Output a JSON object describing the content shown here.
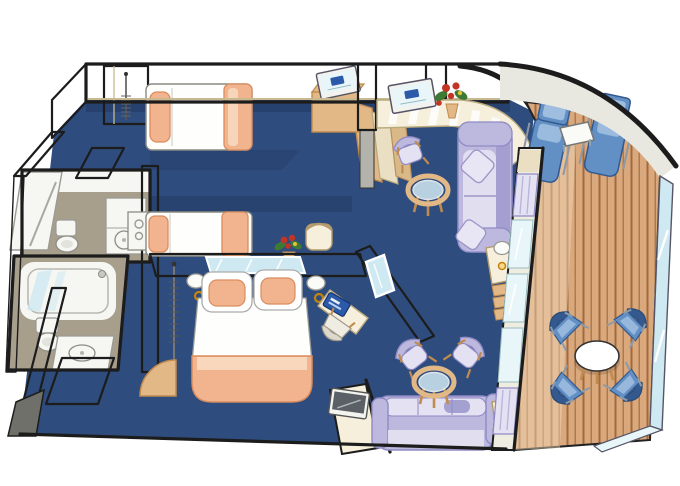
{
  "meta": {
    "kind": "cruise-ship-suite-floor-plan",
    "projection": "oblique-cutaway-illustration",
    "has_text": false
  },
  "palette": {
    "background": "#ffffff",
    "outline": "#1c1c1c",
    "carpet_navy": "#2e4c7d",
    "carpet_navy_dark": "#223962",
    "wall_beige": "#eadfc2",
    "wall_cream": "#f5efdc",
    "wall_gray_light": "#d3d3cc",
    "wall_gray_mid": "#b3b3ac",
    "wall_gray_dark": "#83837c",
    "hull_band": "#e8e8e0",
    "bath_floor_taupe": "#a89e8c",
    "fixture_white": "#f6f6f2",
    "bed_white": "#fefefc",
    "peach": "#f1b48e",
    "peach_deep": "#d98d5e",
    "peach_pale": "#f9ddc4",
    "wood_tan": "#e2b886",
    "wood_deep": "#c08b4e",
    "deck_plank": "#d9a87c",
    "deck_groove": "#a16a3e",
    "deck_plank_light": "#f2dcbc",
    "sofa_lavender": "#bcb8de",
    "sofa_lavender_deep": "#8f8ac4",
    "sofa_lavender_pale": "#e4e2f2",
    "chair_blue": "#6290c4",
    "chair_blue_deep": "#33598e",
    "chair_blue_pale": "#a9c6e4",
    "glass_blue": "#cfe9f2",
    "glass_pale": "#e9f6f9",
    "screen_blue": "#2a5aa8",
    "brass_gold": "#c2840e",
    "flower_red": "#c43424",
    "leaf_green": "#3e7a34"
  },
  "scene": {
    "rooms": [
      {
        "id": "bedroom-forward",
        "floor": "navy-carpet",
        "items": [
          "wardrobe-with-hanger-rail",
          "twin-bed",
          "flat-tv-on-cabinet",
          "open-door"
        ]
      },
      {
        "id": "bedroom-master",
        "floor": "navy-carpet",
        "items": [
          "twin-bed",
          "mini-fridge",
          "flower-vase",
          "vanity-stool",
          "vanity-mirror-strip",
          "bedside-lamp",
          "bedside-lamp",
          "queen-bed",
          "wall-mirror",
          "desk-with-laptop",
          "desk-chair",
          "flat-tv-on-cabinet",
          "sofa",
          "side-table-with-lamp"
        ]
      },
      {
        "id": "bathroom-shower",
        "floor": "taupe-tile",
        "items": [
          "shower-stall",
          "toilet",
          "washbasin-cabinet"
        ]
      },
      {
        "id": "bathroom-tub",
        "floor": "taupe-tile",
        "items": [
          "bathtub",
          "toilet",
          "washbasin-counter",
          "open-door"
        ]
      },
      {
        "id": "living-room",
        "floor": "navy-carpet",
        "items": [
          "counter-with-striped-front",
          "flat-tv-on-counter",
          "flower-vase",
          "dining-chair",
          "round-glass-table",
          "three-seat-sofa",
          "throw-pillow",
          "throw-pillow",
          "side-table-with-lamp",
          "shelf-unit",
          "armchair",
          "armchair",
          "round-glass-coffee-table",
          "curtained-window-wall"
        ]
      },
      {
        "id": "balcony",
        "floor": "teak-deck",
        "items": [
          "sun-lounger",
          "sun-lounger",
          "square-side-table",
          "deck-chair",
          "deck-chair",
          "deck-chair",
          "deck-chair",
          "oval-table",
          "glass-railing"
        ]
      }
    ],
    "counts": {
      "beds": 3,
      "bathrooms": 2,
      "televisions": 3,
      "sofas": 2,
      "balcony_chairs": 4,
      "sun_loungers": 2
    }
  }
}
